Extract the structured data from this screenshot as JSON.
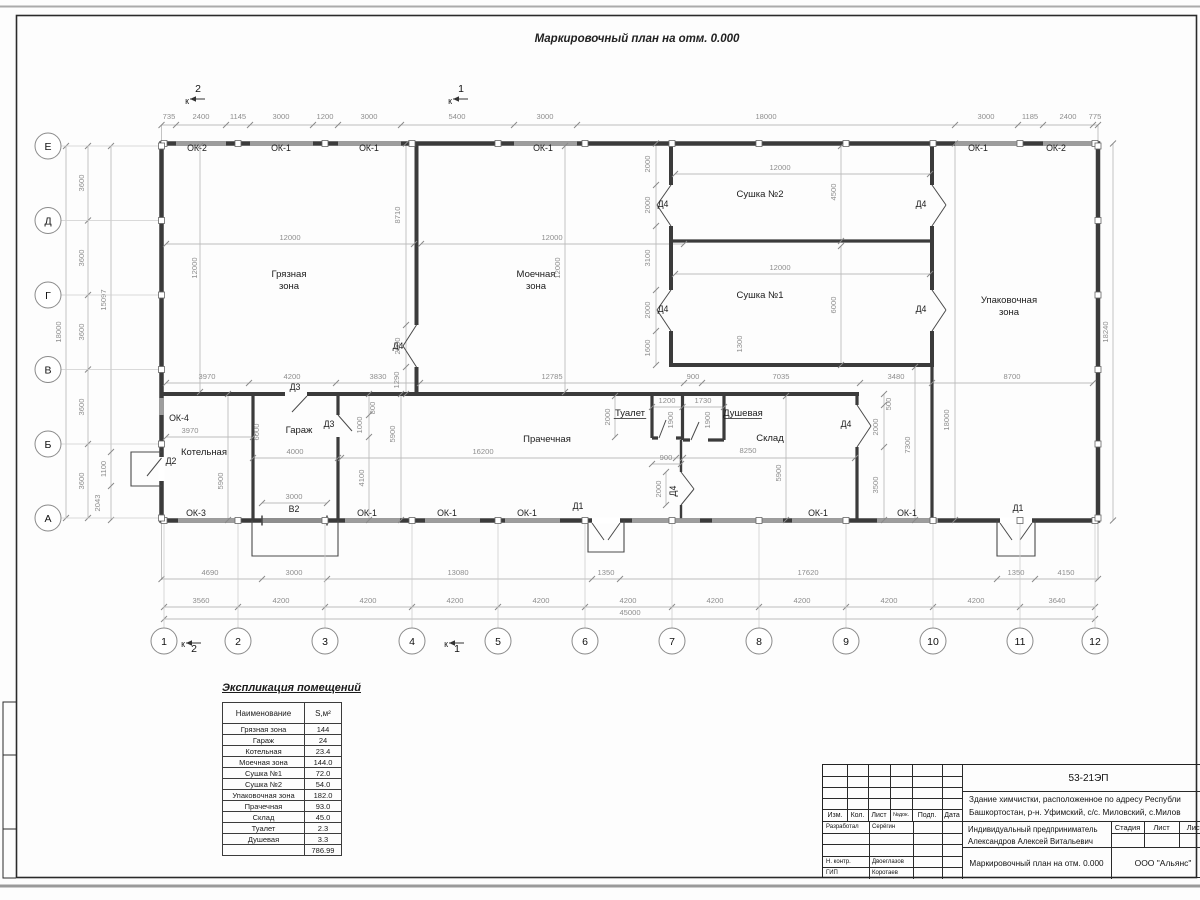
{
  "title": "Маркировочный план на отм. 0.000",
  "plan": {
    "texts": [
      {
        "t": "735",
        "x": 169,
        "y": 119
      },
      {
        "t": "2400",
        "x": 201,
        "y": 119
      },
      {
        "t": "1145",
        "x": 238,
        "y": 119
      },
      {
        "t": "3000",
        "x": 281,
        "y": 119
      },
      {
        "t": "1200",
        "x": 325,
        "y": 119
      },
      {
        "t": "3000",
        "x": 369,
        "y": 119
      },
      {
        "t": "5400",
        "x": 457,
        "y": 119
      },
      {
        "t": "3000",
        "x": 545,
        "y": 119
      },
      {
        "t": "18000",
        "x": 766,
        "y": 119
      },
      {
        "t": "3000",
        "x": 986,
        "y": 119
      },
      {
        "t": "1185",
        "x": 1030,
        "y": 119
      },
      {
        "t": "2400",
        "x": 1068,
        "y": 119
      },
      {
        "t": "775",
        "x": 1095,
        "y": 119
      },
      {
        "t": "3970",
        "x": 207,
        "y": 379
      },
      {
        "t": "4200",
        "x": 292,
        "y": 379
      },
      {
        "t": "3830",
        "x": 378,
        "y": 379
      },
      {
        "t": "12785",
        "x": 552,
        "y": 379
      },
      {
        "t": "900",
        "x": 693,
        "y": 379
      },
      {
        "t": "7035",
        "x": 781,
        "y": 379
      },
      {
        "t": "3480",
        "x": 896,
        "y": 379
      },
      {
        "t": "8700",
        "x": 1012,
        "y": 379
      },
      {
        "t": "12000",
        "x": 290,
        "y": 240
      },
      {
        "t": "12000",
        "x": 552,
        "y": 240
      },
      {
        "t": "12000",
        "x": 197,
        "y": 268,
        "r": -90
      },
      {
        "t": "12000",
        "x": 560,
        "y": 268,
        "r": -90
      },
      {
        "t": "8710",
        "x": 400,
        "y": 215,
        "r": -90
      },
      {
        "t": "2000",
        "x": 400,
        "y": 346,
        "r": -90
      },
      {
        "t": "1290",
        "x": 399,
        "y": 380,
        "r": -90
      },
      {
        "t": "2000",
        "x": 650,
        "y": 164,
        "r": -90
      },
      {
        "t": "2000",
        "x": 650,
        "y": 205,
        "r": -90
      },
      {
        "t": "3100",
        "x": 650,
        "y": 258,
        "r": -90
      },
      {
        "t": "2000",
        "x": 650,
        "y": 310,
        "r": -90
      },
      {
        "t": "1600",
        "x": 650,
        "y": 348,
        "r": -90
      },
      {
        "t": "12000",
        "x": 780,
        "y": 170
      },
      {
        "t": "12000",
        "x": 780,
        "y": 270
      },
      {
        "t": "4500",
        "x": 836,
        "y": 192,
        "r": -90
      },
      {
        "t": "6000",
        "x": 836,
        "y": 305,
        "r": -90
      },
      {
        "t": "1300",
        "x": 742,
        "y": 344,
        "r": -90
      },
      {
        "t": "3600",
        "x": 84,
        "y": 183,
        "r": -90
      },
      {
        "t": "3600",
        "x": 84,
        "y": 258,
        "r": -90
      },
      {
        "t": "3600",
        "x": 84,
        "y": 332,
        "r": -90
      },
      {
        "t": "3600",
        "x": 84,
        "y": 407,
        "r": -90
      },
      {
        "t": "3600",
        "x": 84,
        "y": 481,
        "r": -90
      },
      {
        "t": "18000",
        "x": 61,
        "y": 332,
        "r": -90
      },
      {
        "t": "15097",
        "x": 106,
        "y": 300,
        "r": -90
      },
      {
        "t": "1100",
        "x": 106,
        "y": 469,
        "r": -90
      },
      {
        "t": "2043",
        "x": 100,
        "y": 503,
        "r": -90
      },
      {
        "t": "18240",
        "x": 1108,
        "y": 332,
        "r": -90
      },
      {
        "t": "18000",
        "x": 949,
        "y": 420,
        "r": -90
      },
      {
        "t": "7300",
        "x": 910,
        "y": 445,
        "r": -90
      },
      {
        "t": "500",
        "x": 891,
        "y": 404,
        "r": -90
      },
      {
        "t": "2000",
        "x": 878,
        "y": 427,
        "r": -90
      },
      {
        "t": "3500",
        "x": 878,
        "y": 485,
        "r": -90
      },
      {
        "t": "3970",
        "x": 190,
        "y": 433
      },
      {
        "t": "6000",
        "x": 259,
        "y": 432,
        "r": -90
      },
      {
        "t": "4000",
        "x": 295,
        "y": 454
      },
      {
        "t": "5900",
        "x": 223,
        "y": 481,
        "r": -90
      },
      {
        "t": "3000",
        "x": 294,
        "y": 499
      },
      {
        "t": "4100",
        "x": 364,
        "y": 478,
        "r": -90
      },
      {
        "t": "1000",
        "x": 362,
        "y": 425,
        "r": -90
      },
      {
        "t": "800",
        "x": 375,
        "y": 408,
        "r": -90
      },
      {
        "t": "5900",
        "x": 395,
        "y": 434,
        "r": -90
      },
      {
        "t": "16200",
        "x": 483,
        "y": 454
      },
      {
        "t": "2000",
        "x": 610,
        "y": 417,
        "r": -90
      },
      {
        "t": "1200",
        "x": 667,
        "y": 403
      },
      {
        "t": "1730",
        "x": 703,
        "y": 403
      },
      {
        "t": "1900",
        "x": 673,
        "y": 420,
        "r": -90
      },
      {
        "t": "1900",
        "x": 710,
        "y": 420,
        "r": -90
      },
      {
        "t": "900",
        "x": 666,
        "y": 460
      },
      {
        "t": "2000",
        "x": 661,
        "y": 489,
        "r": -90
      },
      {
        "t": "8250",
        "x": 748,
        "y": 453
      },
      {
        "t": "5900",
        "x": 781,
        "y": 473,
        "r": -90
      },
      {
        "t": "4690",
        "x": 210,
        "y": 575
      },
      {
        "t": "3000",
        "x": 294,
        "y": 575
      },
      {
        "t": "13080",
        "x": 458,
        "y": 575
      },
      {
        "t": "1350",
        "x": 606,
        "y": 575
      },
      {
        "t": "17620",
        "x": 808,
        "y": 575
      },
      {
        "t": "1350",
        "x": 1016,
        "y": 575
      },
      {
        "t": "4150",
        "x": 1066,
        "y": 575
      },
      {
        "t": "3560",
        "x": 201,
        "y": 603
      },
      {
        "t": "4200",
        "x": 281,
        "y": 603
      },
      {
        "t": "4200",
        "x": 368,
        "y": 603
      },
      {
        "t": "4200",
        "x": 455,
        "y": 603
      },
      {
        "t": "4200",
        "x": 541,
        "y": 603
      },
      {
        "t": "4200",
        "x": 628,
        "y": 603
      },
      {
        "t": "4200",
        "x": 715,
        "y": 603
      },
      {
        "t": "4200",
        "x": 802,
        "y": 603
      },
      {
        "t": "4200",
        "x": 889,
        "y": 603
      },
      {
        "t": "4200",
        "x": 976,
        "y": 603
      },
      {
        "t": "3640",
        "x": 1057,
        "y": 603
      },
      {
        "t": "45000",
        "x": 630,
        "y": 615
      },
      {
        "t": "Грязная",
        "x": 289,
        "y": 277,
        "c": "l"
      },
      {
        "t": "зона",
        "x": 289,
        "y": 289,
        "c": "l"
      },
      {
        "t": "Моечная",
        "x": 536,
        "y": 277,
        "c": "l"
      },
      {
        "t": "зона",
        "x": 536,
        "y": 289,
        "c": "l"
      },
      {
        "t": "Сушка №2",
        "x": 760,
        "y": 197,
        "c": "l"
      },
      {
        "t": "Сушка №1",
        "x": 760,
        "y": 298,
        "c": "l"
      },
      {
        "t": "Упаковочная",
        "x": 1009,
        "y": 303,
        "c": "l"
      },
      {
        "t": "зона",
        "x": 1009,
        "y": 315,
        "c": "l"
      },
      {
        "t": "Котельная",
        "x": 204,
        "y": 455,
        "c": "l"
      },
      {
        "t": "Гараж",
        "x": 299,
        "y": 433,
        "c": "l"
      },
      {
        "t": "Прачечная",
        "x": 547,
        "y": 442,
        "c": "l"
      },
      {
        "t": "Склад",
        "x": 770,
        "y": 441,
        "c": "l"
      },
      {
        "t": "Туалет",
        "x": 630,
        "y": 416,
        "c": "l",
        "u": 1
      },
      {
        "t": "Душевая",
        "x": 743,
        "y": 416,
        "c": "l",
        "u": 1
      },
      {
        "t": "ОК-2",
        "x": 197,
        "y": 151,
        "c": "t"
      },
      {
        "t": "ОК-1",
        "x": 281,
        "y": 151,
        "c": "t"
      },
      {
        "t": "ОК-1",
        "x": 369,
        "y": 151,
        "c": "t"
      },
      {
        "t": "ОК-1",
        "x": 543,
        "y": 151,
        "c": "t"
      },
      {
        "t": "ОК-1",
        "x": 978,
        "y": 151,
        "c": "t"
      },
      {
        "t": "ОК-2",
        "x": 1056,
        "y": 151,
        "c": "t"
      },
      {
        "t": "ОК-3",
        "x": 196,
        "y": 516,
        "c": "t"
      },
      {
        "t": "ОК-1",
        "x": 367,
        "y": 516,
        "c": "t"
      },
      {
        "t": "ОК-1",
        "x": 447,
        "y": 516,
        "c": "t"
      },
      {
        "t": "ОК-1",
        "x": 527,
        "y": 516,
        "c": "t"
      },
      {
        "t": "ОК-1",
        "x": 818,
        "y": 516,
        "c": "t"
      },
      {
        "t": "ОК-1",
        "x": 907,
        "y": 516,
        "c": "t"
      },
      {
        "t": "ОК-4",
        "x": 179,
        "y": 421,
        "c": "t"
      },
      {
        "t": "Д1",
        "x": 578,
        "y": 509,
        "c": "t"
      },
      {
        "t": "Д1",
        "x": 1018,
        "y": 511,
        "c": "t"
      },
      {
        "t": "Д2",
        "x": 171,
        "y": 464,
        "c": "t"
      },
      {
        "t": "Д3",
        "x": 295,
        "y": 390,
        "c": "t"
      },
      {
        "t": "Д3",
        "x": 329,
        "y": 427,
        "c": "t"
      },
      {
        "t": "Д4",
        "x": 398,
        "y": 349,
        "c": "t"
      },
      {
        "t": "Д4",
        "x": 663,
        "y": 207,
        "c": "t"
      },
      {
        "t": "Д4",
        "x": 663,
        "y": 312,
        "c": "t"
      },
      {
        "t": "Д4",
        "x": 921,
        "y": 207,
        "c": "t"
      },
      {
        "t": "Д4",
        "x": 921,
        "y": 312,
        "c": "t"
      },
      {
        "t": "Д4",
        "x": 846,
        "y": 427,
        "c": "t"
      },
      {
        "t": "Д4",
        "x": 676,
        "y": 491,
        "r": -90,
        "c": "t"
      },
      {
        "t": "В2",
        "x": 294,
        "y": 512,
        "c": "t"
      },
      {
        "t": "2",
        "x": 198,
        "y": 92,
        "c": "a"
      },
      {
        "t": "1",
        "x": 461,
        "y": 92,
        "c": "a"
      },
      {
        "t": "2",
        "x": 194,
        "y": 652,
        "c": "a"
      },
      {
        "t": "1",
        "x": 457,
        "y": 652,
        "c": "a"
      },
      {
        "t": "к",
        "x": 187,
        "y": 104,
        "c": "t"
      },
      {
        "t": "к",
        "x": 450,
        "y": 104,
        "c": "t"
      },
      {
        "t": "к",
        "x": 183,
        "y": 647,
        "c": "t"
      },
      {
        "t": "к",
        "x": 446,
        "y": 647,
        "c": "t"
      }
    ],
    "tick_rows": [
      {
        "y": 125,
        "xs": [
          161.5,
          176,
          226,
          250,
          313,
          338,
          401,
          514,
          577,
          955,
          1018,
          1043,
          1093,
          1098
        ]
      },
      {
        "y": 244,
        "xs": [
          166,
          414,
          421,
          684
        ]
      },
      {
        "y": 174,
        "xs": [
          675,
          930
        ]
      },
      {
        "y": 274,
        "xs": [
          675,
          930
        ]
      },
      {
        "y": 383,
        "xs": [
          166,
          249,
          336,
          420,
          684,
          702,
          860,
          932,
          1093
        ]
      },
      {
        "y": 437,
        "xs": [
          166,
          253
        ]
      },
      {
        "y": 458,
        "xs": [
          253,
          338,
          341,
          676,
          683,
          855
        ]
      },
      {
        "y": 503,
        "xs": [
          262,
          327
        ]
      },
      {
        "y": 407,
        "xs": [
          652,
          682.5,
          724
        ]
      },
      {
        "y": 464,
        "xs": [
          652,
          681
        ]
      },
      {
        "y": 579,
        "xs": [
          161.5,
          262,
          327,
          592,
          620,
          997,
          1035,
          1098
        ]
      },
      {
        "y": 607,
        "xs": [
          164,
          238,
          325,
          412,
          498,
          585,
          672,
          759,
          846,
          933,
          1020,
          1095
        ]
      },
      {
        "y": 619,
        "xs": [
          164,
          1095
        ]
      }
    ],
    "tick_cols": [
      {
        "x": 656,
        "ys": [
          143.5,
          185,
          226,
          290,
          331,
          365
        ]
      },
      {
        "x": 841,
        "ys": [
          146,
          241,
          246,
          365
        ]
      },
      {
        "x": 406,
        "ys": [
          143.5,
          325,
          367,
          394
        ]
      },
      {
        "x": 200,
        "ys": [
          146,
          392
        ]
      },
      {
        "x": 565,
        "ys": [
          146,
          392
        ]
      },
      {
        "x": 228,
        "ys": [
          394,
          520
        ]
      },
      {
        "x": 369,
        "ys": [
          394,
          415,
          437,
          520
        ]
      },
      {
        "x": 401,
        "ys": [
          394,
          520
        ]
      },
      {
        "x": 615,
        "ys": [
          396,
          437
        ]
      },
      {
        "x": 666,
        "ys": [
          472,
          505
        ]
      },
      {
        "x": 786,
        "ys": [
          396,
          520
        ]
      },
      {
        "x": 884,
        "ys": [
          394,
          405,
          447,
          520
        ]
      },
      {
        "x": 915,
        "ys": [
          367,
          520
        ]
      },
      {
        "x": 955,
        "ys": [
          143.5,
          520
        ]
      },
      {
        "x": 1113,
        "ys": [
          143.5,
          520.5
        ]
      },
      {
        "x": 88,
        "ys": [
          146,
          220.5,
          295,
          369.5,
          444,
          518
        ]
      },
      {
        "x": 66,
        "ys": [
          146,
          518
        ]
      },
      {
        "x": 111,
        "ys": [
          146,
          452,
          486,
          520
        ]
      }
    ],
    "axes_x": [
      {
        "n": "1",
        "x": 164
      },
      {
        "n": "2",
        "x": 238
      },
      {
        "n": "3",
        "x": 325
      },
      {
        "n": "4",
        "x": 412
      },
      {
        "n": "5",
        "x": 498
      },
      {
        "n": "6",
        "x": 585
      },
      {
        "n": "7",
        "x": 672
      },
      {
        "n": "8",
        "x": 759
      },
      {
        "n": "9",
        "x": 846
      },
      {
        "n": "10",
        "x": 933
      },
      {
        "n": "11",
        "x": 1020
      },
      {
        "n": "12",
        "x": 1095
      }
    ],
    "axes_y": [
      {
        "n": "Е",
        "y": 146
      },
      {
        "n": "Д",
        "y": 220.5
      },
      {
        "n": "Г",
        "y": 295
      },
      {
        "n": "В",
        "y": 369.5
      },
      {
        "n": "Б",
        "y": 444
      },
      {
        "n": "А",
        "y": 518
      }
    ]
  },
  "explication": {
    "title": "Экспликация помещений",
    "col_name": "Наименование",
    "col_area": "S,м²",
    "rows": [
      [
        "Грязная зона",
        "144"
      ],
      [
        "Гараж",
        "24"
      ],
      [
        "Котельная",
        "23.4"
      ],
      [
        "Моечная зона",
        "144.0"
      ],
      [
        "Сушка №1",
        "72.0"
      ],
      [
        "Сушка №2",
        "54.0"
      ],
      [
        "Упаковочная зона",
        "182.0"
      ],
      [
        "Прачечная",
        "93.0"
      ],
      [
        "Склад",
        "45.0"
      ],
      [
        "Туалет",
        "2.3"
      ],
      [
        "Душевая",
        "3.3"
      ],
      [
        "",
        "786.99"
      ]
    ]
  },
  "titleblock": {
    "doc_number": "53-21ЭП",
    "object_line1": "Здание химчистки,  расположенное по адресу Республи",
    "object_line2": "Башкортостан, р-н. Уфимский, с/с. Миловский, с.Милов",
    "header_cols": [
      "Изм.",
      "Кол.",
      "Лист",
      "№док.",
      "Подп.",
      "Дата"
    ],
    "razrab_role": "Разработал",
    "razrab_name": "Серёгин",
    "nk_role": "Н. контр.",
    "nk_name": "Двоеглазов",
    "gip_role": "ГИП",
    "gip_name": "Коротаев",
    "client_line1": "Индивидуальный предприниматель",
    "client_line2": "Александров Алексей Витальевич",
    "stage_cols": [
      "Стадия",
      "Лист",
      "Листо"
    ],
    "drawing_title": "Маркировочный план на отм. 0.000",
    "company": "ООО \"Альянс\""
  }
}
